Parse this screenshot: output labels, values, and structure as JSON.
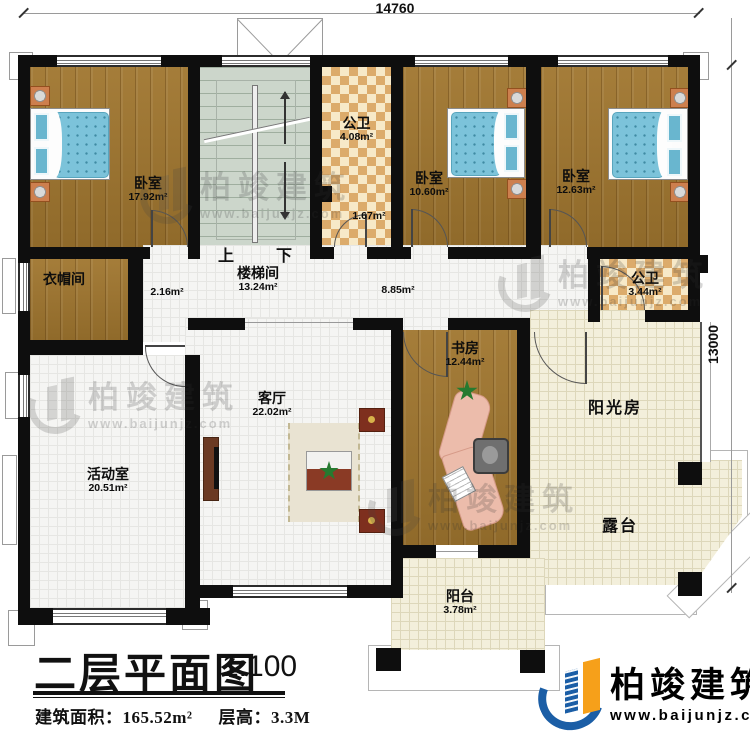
{
  "dimensions": {
    "top": "14760",
    "right": "13000"
  },
  "stairs": {
    "up": "上",
    "down": "下"
  },
  "rooms": {
    "bedroom1": {
      "name": "卧室",
      "area": "17.92m²"
    },
    "stairwell": {
      "name": "楼梯间",
      "area": "13.24m²"
    },
    "bath1": {
      "name": "公卫",
      "area": "4.08m²"
    },
    "bath1b": {
      "area": "1.67m²"
    },
    "bedroom2": {
      "name": "卧室",
      "area": "10.60m²"
    },
    "bedroom3": {
      "name": "卧室",
      "area": "12.63m²"
    },
    "cloakroom": {
      "name": "衣帽间"
    },
    "corridor": {
      "area": "2.16m²"
    },
    "hallway": {
      "area": "8.85m²"
    },
    "bath2": {
      "name": "公卫",
      "area": "3.44m²"
    },
    "study": {
      "name": "书房",
      "area": "12.44m²"
    },
    "living": {
      "name": "客厅",
      "area": "22.02m²"
    },
    "activity": {
      "name": "活动室",
      "area": "20.51m²"
    },
    "sunroom": {
      "name": "阳光房"
    },
    "terrace": {
      "name": "露台"
    },
    "balcony": {
      "name": "阳台",
      "area": "3.78m²"
    }
  },
  "title_block": {
    "title": "二层平面图",
    "scale": "1:100",
    "area_label": "建筑面积：165.52m²",
    "floor_height_label": "层高：3.3M"
  },
  "brand": {
    "name": "柏竣建筑",
    "website": "www.baijunjz.com"
  }
}
